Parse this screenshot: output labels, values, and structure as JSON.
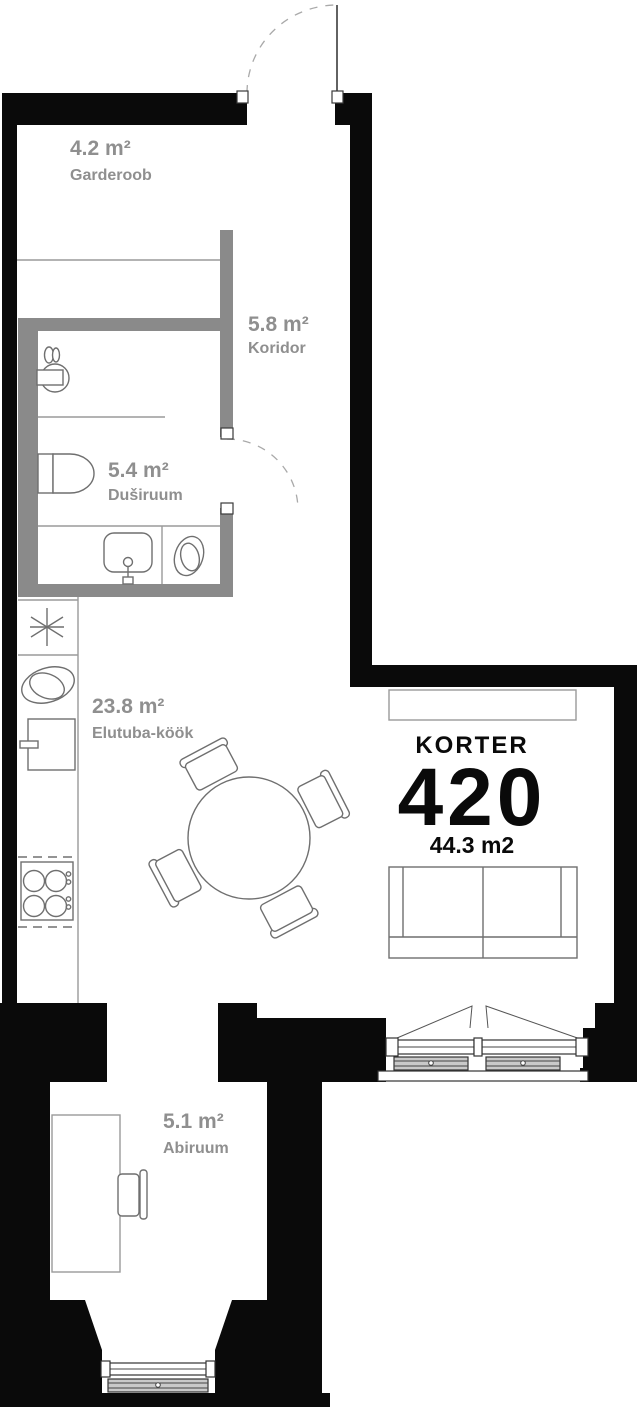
{
  "title": {
    "label": "KORTER",
    "number": "420",
    "area": "44.3 m2"
  },
  "rooms": [
    {
      "area": "4.2 m²",
      "name": "Garderoob"
    },
    {
      "area": "5.8 m²",
      "name": "Koridor"
    },
    {
      "area": "5.4 m²",
      "name": "Duširuum"
    },
    {
      "area": "23.8 m²",
      "name": "Elutuba-köök"
    },
    {
      "area": "5.1 m²",
      "name": "Abiruum"
    }
  ],
  "colors": {
    "exterior_wall": "#0a0a0a",
    "partition_wall": "#8a8a8a",
    "room_label": "#8f8f8f",
    "title_text": "#0a0a0a"
  }
}
